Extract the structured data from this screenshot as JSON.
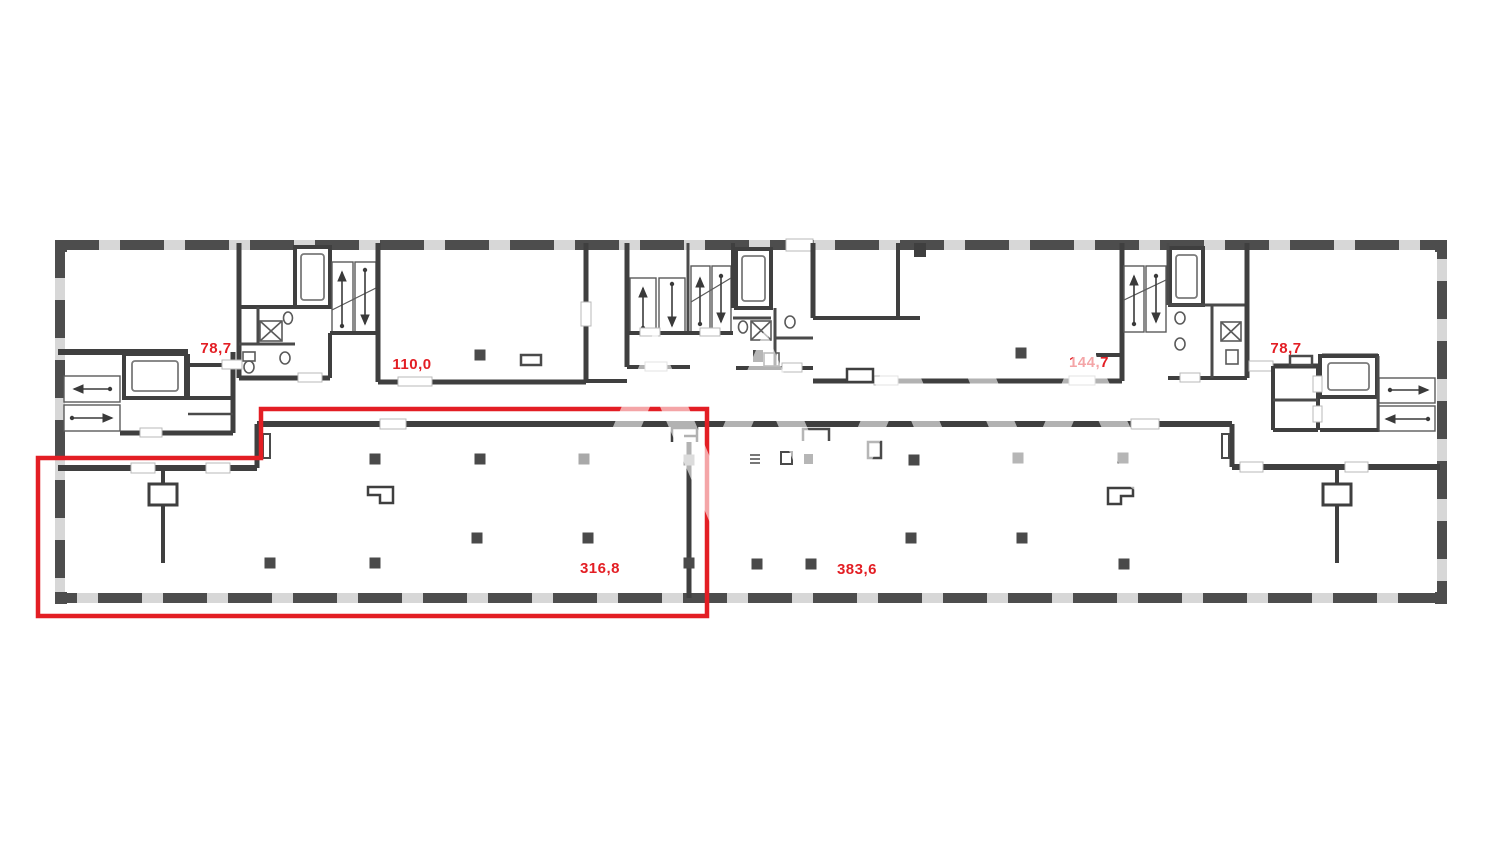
{
  "plan": {
    "type": "architectural-floor-plan",
    "colors": {
      "background": "#ffffff",
      "wall_dark": "#3f3f3f",
      "wall_dash_dark": "#4d4d4d",
      "wall_dash_light": "#d7d7d7",
      "highlight_red": "#e31e24",
      "column_dark": "#4a4a4a",
      "column_light": "#a9a9a9",
      "stair_tread": "#8c8c8c"
    },
    "area_labels": [
      {
        "id": "left-78-7",
        "text": "78,7",
        "x": 216,
        "y": 353
      },
      {
        "id": "room-110-0",
        "text": "110,0",
        "x": 412,
        "y": 369
      },
      {
        "id": "room-144-7",
        "text": "144,7",
        "x": 1089,
        "y": 367
      },
      {
        "id": "right-78-7",
        "text": "78,7",
        "x": 1286,
        "y": 353
      },
      {
        "id": "space-316-8",
        "text": "316,8",
        "x": 600,
        "y": 573
      },
      {
        "id": "space-383-6",
        "text": "383,6",
        "x": 857,
        "y": 574
      }
    ],
    "highlight_outline": {
      "points": [
        [
          38,
          458
        ],
        [
          261,
          458
        ],
        [
          261,
          409
        ],
        [
          707,
          409
        ],
        [
          707,
          616
        ],
        [
          38,
          616
        ]
      ],
      "color": "#e31e24",
      "stroke_width": 4.5
    },
    "columns": {
      "size": 11,
      "items": [
        [
          375,
          459,
          "d"
        ],
        [
          480,
          459,
          "d"
        ],
        [
          584,
          459,
          "l"
        ],
        [
          477,
          538,
          "d"
        ],
        [
          588,
          538,
          "d"
        ],
        [
          270,
          563,
          "d"
        ],
        [
          375,
          563,
          "d"
        ],
        [
          689,
          460,
          "l"
        ],
        [
          689,
          563,
          "d"
        ],
        [
          914,
          460,
          "d"
        ],
        [
          1018,
          458,
          "d"
        ],
        [
          1123,
          458,
          "d"
        ],
        [
          911,
          538,
          "d"
        ],
        [
          1022,
          538,
          "d"
        ],
        [
          757,
          564,
          "d"
        ],
        [
          811,
          564,
          "d"
        ],
        [
          1124,
          564,
          "d"
        ],
        [
          480,
          355,
          "d"
        ],
        [
          1021,
          353,
          "d"
        ]
      ]
    }
  }
}
